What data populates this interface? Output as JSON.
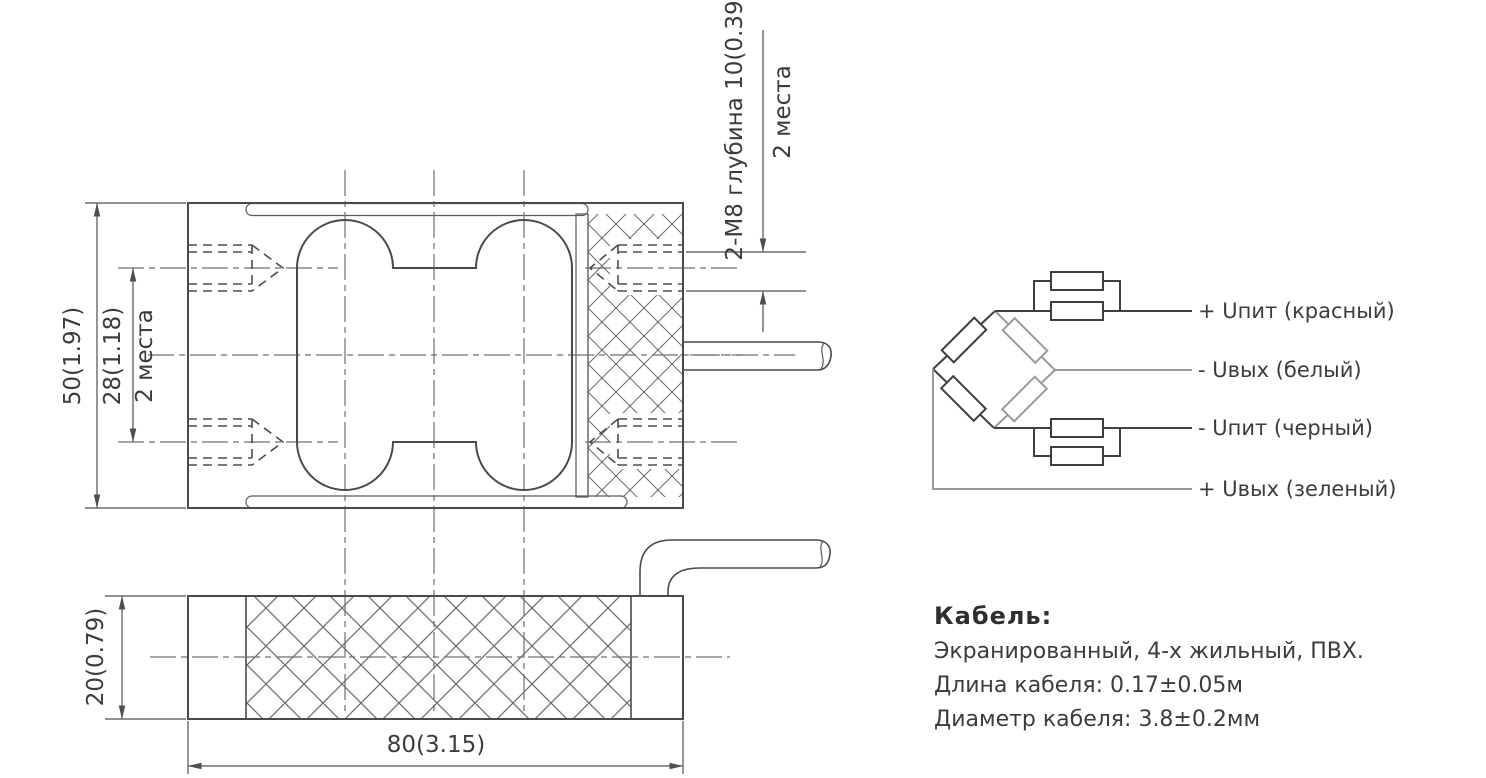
{
  "colors": {
    "background": "#ffffff",
    "line": "#4a4a4a",
    "centerline": "#6f6f6f",
    "text": "#3c3c3c",
    "wire_light": "#9a9a9a"
  },
  "dimensions": {
    "height": "50(1.97)",
    "hole_spacing": "28(1.18)",
    "hole_spacing_places": "2 места",
    "thread_spec": "2-M8 глубина 10(0.39)",
    "thread_places": "2 места",
    "thickness": "20(0.79)",
    "length": "80(3.15)"
  },
  "wiring": {
    "labels": [
      "+ Uпит (красный)",
      "- Uвых (белый)",
      "- Uпит (черный)",
      "+ Uвых (зеленый)"
    ]
  },
  "cable": {
    "heading": "Кабель:",
    "specs": [
      "Экранированный, 4-х жильный, ПВХ.",
      "Длина кабеля: 0.17±0.05м",
      "Диаметр кабеля:  3.8±0.2мм"
    ]
  }
}
